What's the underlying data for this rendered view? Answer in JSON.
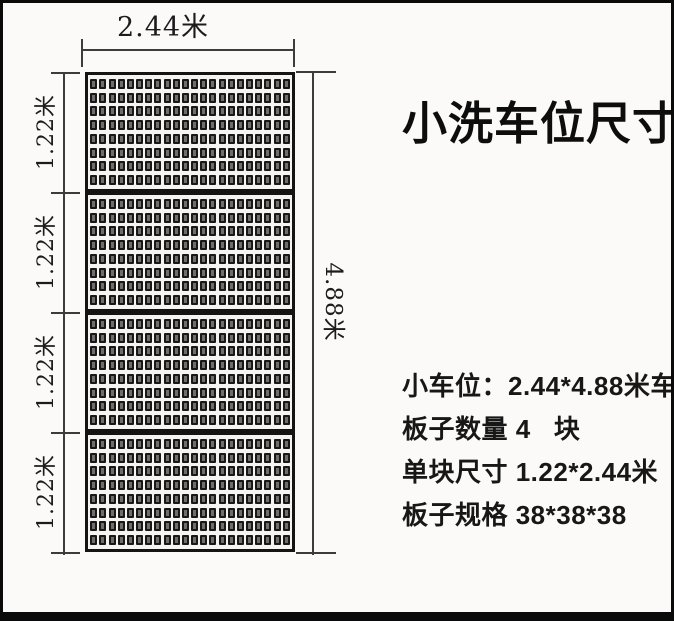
{
  "title": "小洗车位尺寸",
  "diagram": {
    "top_dimension_label": "2.44米",
    "height_dimension_label": "4.88米",
    "segment_labels": [
      "1.22米",
      "1.22米",
      "1.22米",
      "1.22米"
    ],
    "panel_count": 4,
    "grid_rows": 8,
    "grid_cols": 22
  },
  "specs": [
    "小车位：2.44*4.88米车位",
    "板子数量 4   块",
    "单块尺寸 1.22*2.44米",
    "板子规格 38*38*38"
  ],
  "colors": {
    "ink": "#111111",
    "dim_line": "#3c3c3c",
    "panel_border": "#141414",
    "cell_fill": "#6e6e6e",
    "background": "#fbfaf8"
  }
}
